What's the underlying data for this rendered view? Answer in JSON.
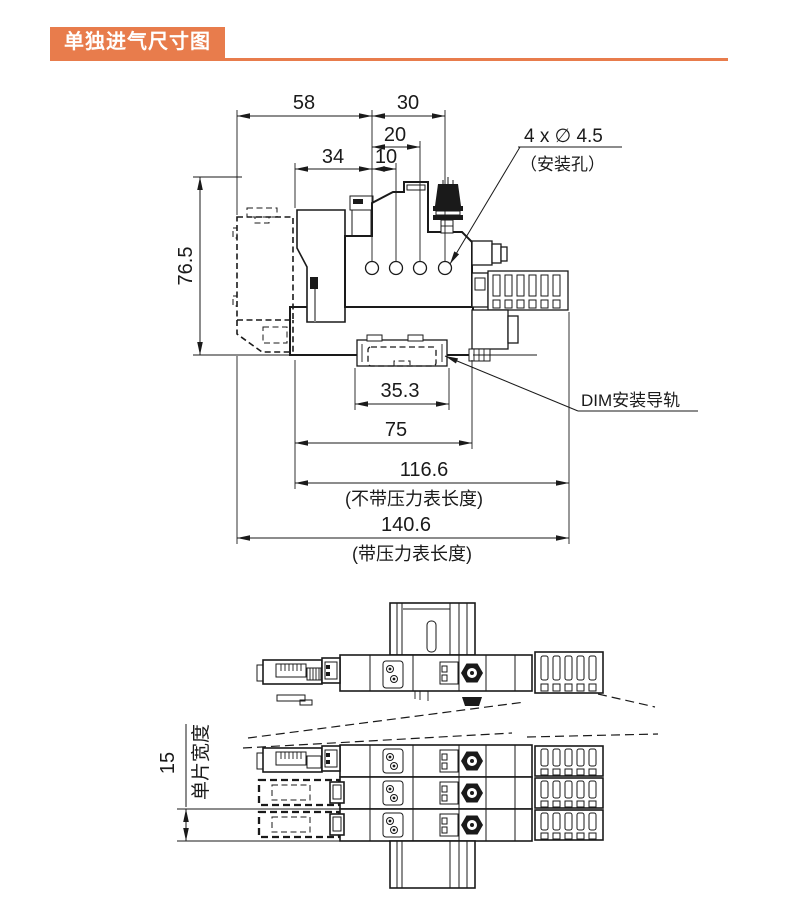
{
  "header": {
    "title": "单独进气尺寸图"
  },
  "colors": {
    "accent": "#E87C4C",
    "line": "#1A1A1A",
    "background": "#FFFFFF"
  },
  "side_view": {
    "dims": {
      "w58": "58",
      "w30": "30",
      "w20": "20",
      "w34": "34",
      "w10": "10",
      "h76_5": "76.5",
      "w35_3": "35.3",
      "w75": "75",
      "w116_6": "116.6",
      "w140_6": "140.6"
    },
    "notes": {
      "without_gauge": "(不带压力表长度)",
      "with_gauge": "(带压力表长度)"
    },
    "callouts": {
      "mounting_holes_spec": "4 x ∅ 4.5",
      "mounting_holes_name": "（安装孔）",
      "din_rail": "DIM安装导轨"
    }
  },
  "top_view": {
    "dims": {
      "slice_width": "15"
    },
    "notes": {
      "slice_width_label": "单片宽度"
    }
  }
}
